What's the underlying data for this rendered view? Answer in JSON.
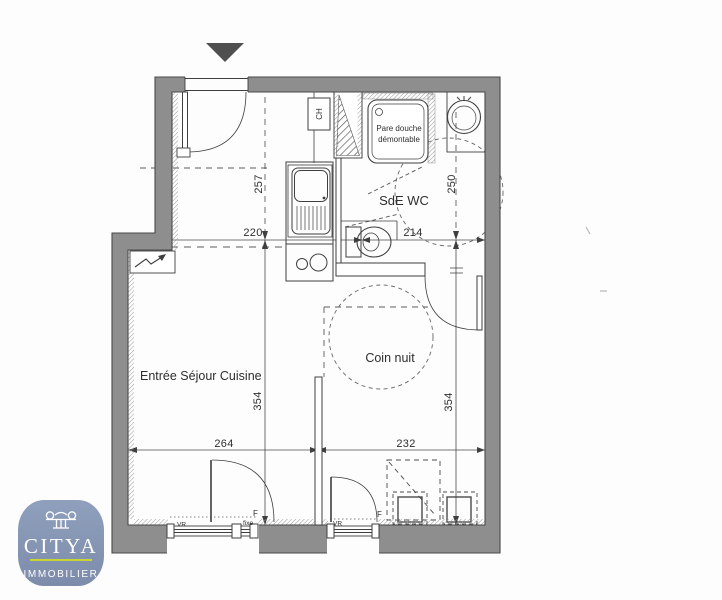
{
  "plan": {
    "rooms": {
      "living": "Entrée Séjour Cuisine",
      "sleeping": "Coin nuit",
      "bathroom": "SdE WC"
    },
    "annotations": {
      "shower_line1": "Pare douche",
      "shower_line2": "démontable",
      "water_heater": "CH"
    },
    "dimensions": {
      "top_left_width": "220",
      "top_right_width": "214",
      "upper_left_depth": "257",
      "upper_right_depth": "250",
      "lower_left_width": "264",
      "lower_right_width": "232",
      "lower_left_depth": "354",
      "lower_right_depth": "354"
    },
    "windows": {
      "w1_shutter": "VR",
      "w1_fixed": "fixe",
      "w1_type": "F",
      "w2_shutter": "VR",
      "w2_type": "F"
    }
  },
  "logo": {
    "brand": "CITYA",
    "subtitle": "IMMOBILIER"
  },
  "colors": {
    "wall_gray": "#8e8e8e",
    "line": "#3f3f3f",
    "logo_blue": "#8494b1",
    "logo_accent": "#c9d435"
  }
}
